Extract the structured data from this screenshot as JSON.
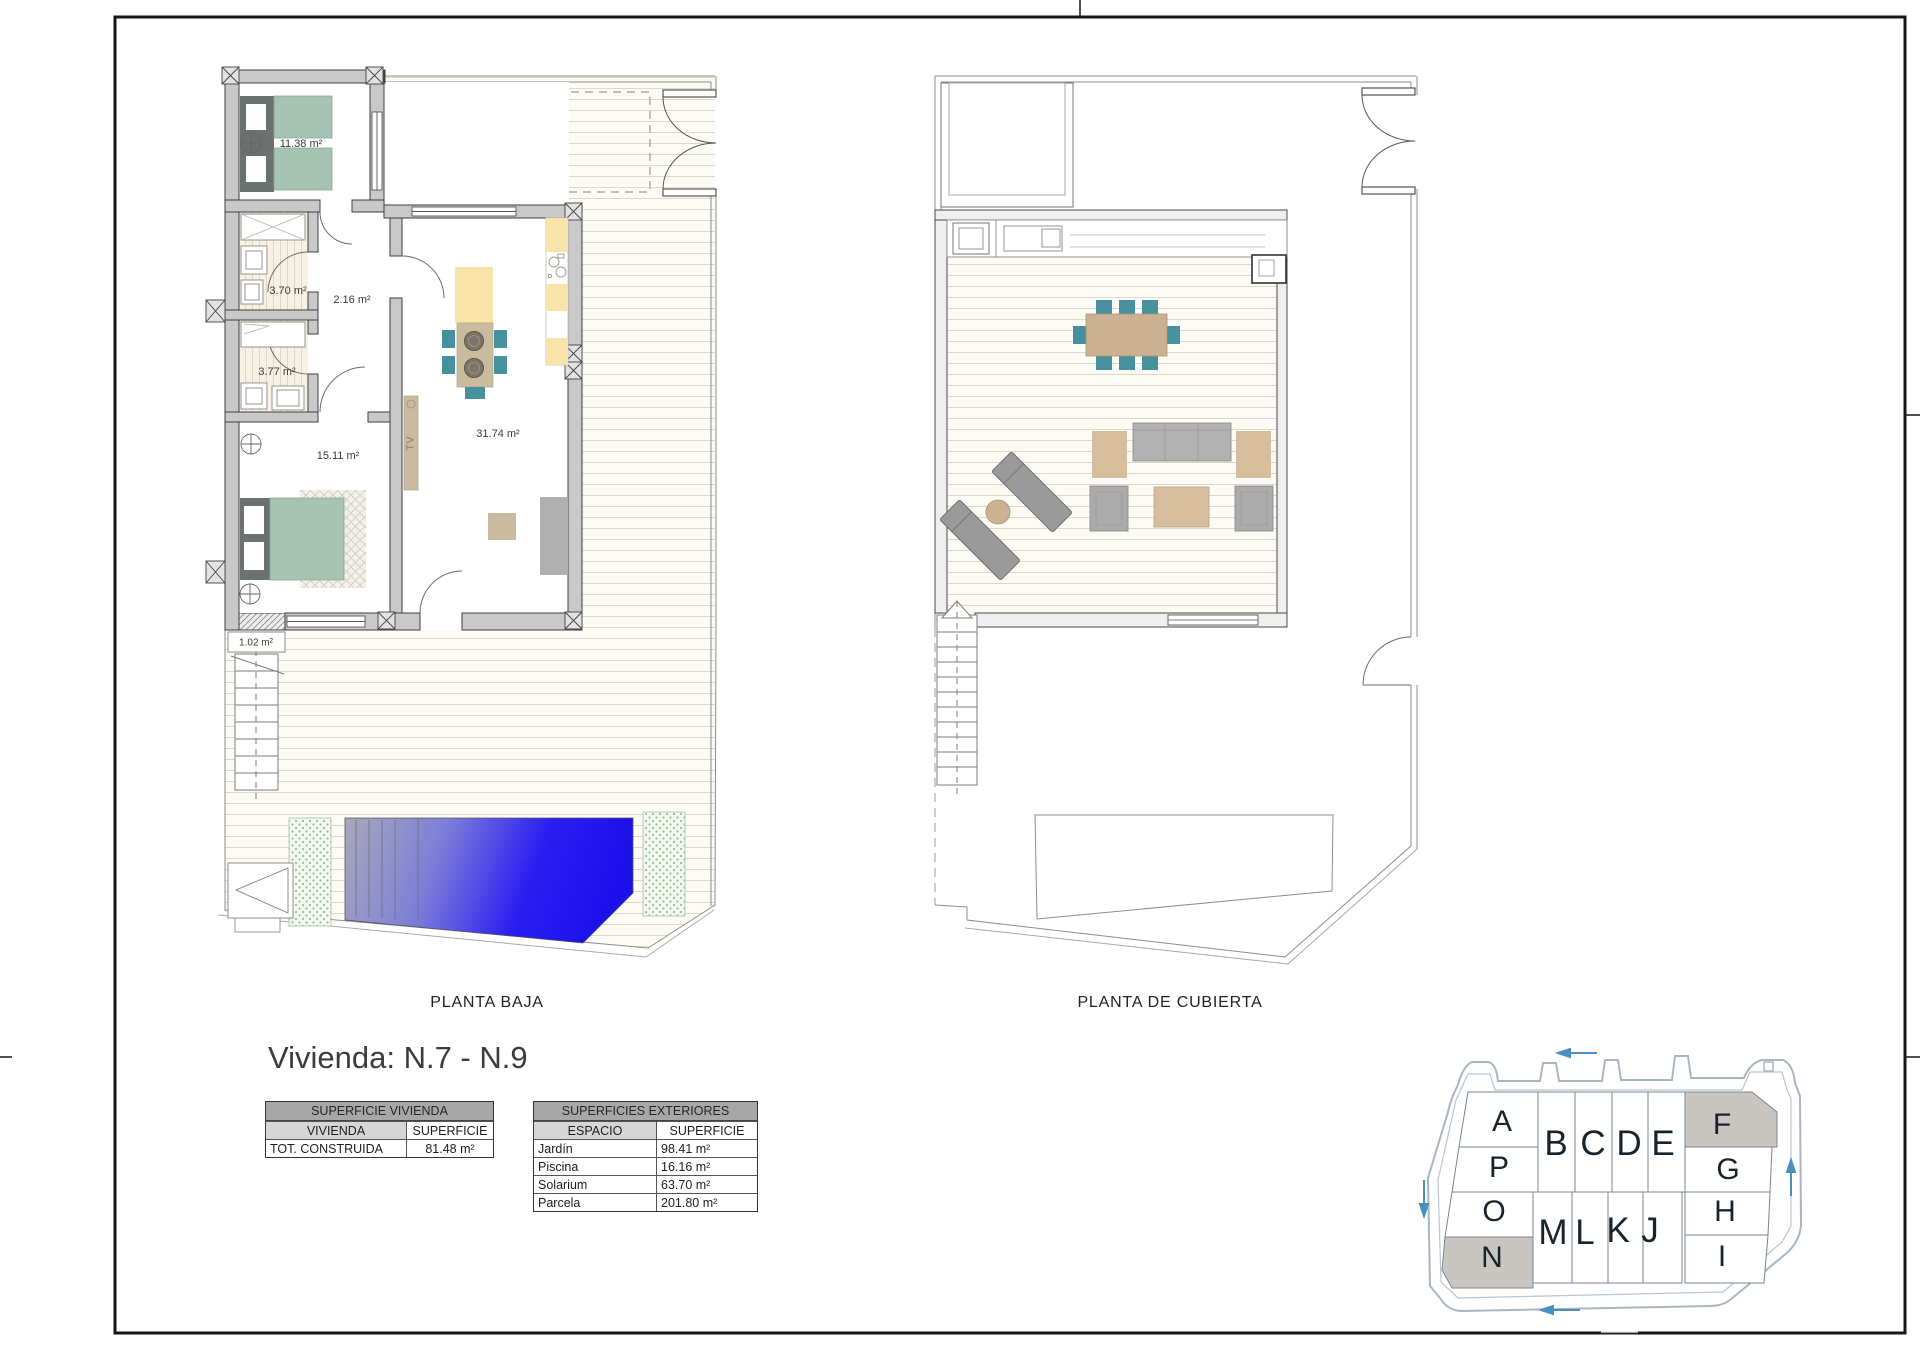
{
  "title": "Vivienda: N.7 - N.9",
  "plans": {
    "baja": {
      "caption": "PLANTA BAJA",
      "rooms": [
        {
          "id": "bedroom-1",
          "area": "11.38 m²"
        },
        {
          "id": "bathroom-1",
          "area": "3.70 m²"
        },
        {
          "id": "hall",
          "area": "2.16 m²"
        },
        {
          "id": "bathroom-2",
          "area": "3.77 m²"
        },
        {
          "id": "bedroom-2",
          "area": "15.11 m²"
        },
        {
          "id": "living-kitchen",
          "area": "31.74 m²"
        },
        {
          "id": "entry-step",
          "area": "1.02 m²"
        }
      ],
      "tv_label": "TV"
    },
    "cubierta": {
      "caption": "PLANTA DE CUBIERTA"
    }
  },
  "tables": {
    "vivienda": {
      "title": "SUPERFICIE VIVIENDA",
      "headers": {
        "col1": "VIVIENDA",
        "col2": "SUPERFICIE"
      },
      "rows": [
        {
          "label": "TOT. CONSTRUIDA",
          "value": "81.48 m²"
        }
      ]
    },
    "exteriores": {
      "title": "SUPERFICIES EXTERIORES",
      "headers": {
        "col1": "ESPACIO",
        "col2": "SUPERFICIE"
      },
      "rows": [
        {
          "label": "Jardín",
          "value": "98.41 m²"
        },
        {
          "label": "Piscina",
          "value": "16.16 m²"
        },
        {
          "label": "Solarium",
          "value": "63.70 m²"
        },
        {
          "label": "Parcela",
          "value": "201.80 m²"
        }
      ]
    }
  },
  "siteplan": {
    "plots": [
      {
        "label": "A",
        "highlighted": false
      },
      {
        "label": "P",
        "highlighted": false
      },
      {
        "label": "O",
        "highlighted": false
      },
      {
        "label": "N",
        "highlighted": true
      },
      {
        "label": "B",
        "highlighted": false
      },
      {
        "label": "C",
        "highlighted": false
      },
      {
        "label": "D",
        "highlighted": false
      },
      {
        "label": "E",
        "highlighted": false
      },
      {
        "label": "F",
        "highlighted": true
      },
      {
        "label": "G",
        "highlighted": false
      },
      {
        "label": "H",
        "highlighted": false
      },
      {
        "label": "I",
        "highlighted": false
      },
      {
        "label": "M",
        "highlighted": false
      },
      {
        "label": "L",
        "highlighted": false
      },
      {
        "label": "K",
        "highlighted": false
      },
      {
        "label": "J",
        "highlighted": false
      }
    ]
  },
  "colors": {
    "pool_blue": "#1b12ee",
    "pool_gray": "#a9a9bb",
    "bed_green": "#a6c3b4",
    "chair_teal": "#47909e",
    "kitchen_yellow": "#f8e3a8",
    "wood_tan": "#cbbb9e",
    "wall_gray": "#c9c9c9",
    "highlight_plot_gray": "#c9c6c1",
    "arrow_blue": "#4a8fc0"
  }
}
